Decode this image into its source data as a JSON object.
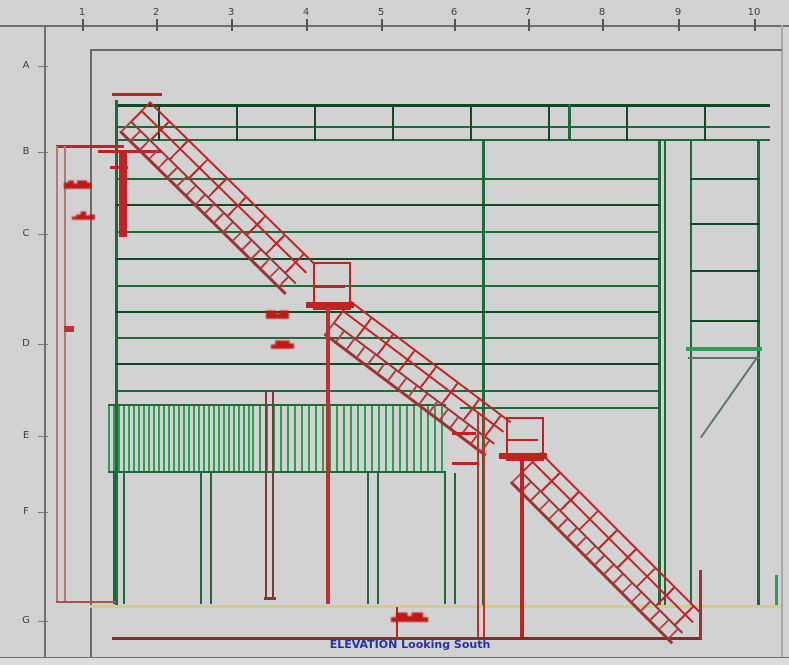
{
  "drawing": {
    "type": "CAD structural elevation drawing",
    "title_caption": "ELEVATION Looking South",
    "grid": {
      "column_labels": [
        "1",
        "2",
        "3",
        "4",
        "5",
        "6",
        "7",
        "8",
        "9",
        "10"
      ],
      "row_labels": [
        "A",
        "B",
        "C",
        "D",
        "E",
        "F",
        "G"
      ]
    },
    "annotations": {
      "elev_note_upper_1": "▆█▅██▆",
      "elev_note_upper_2": "▃▅█▄▅",
      "elev_note_mid_1": "██▅██",
      "elev_note_mid_2": "▄███▅",
      "note_bottom": "▄██▅██▄"
    },
    "colors": {
      "sheet_bg": "#d2d2d2",
      "frame_gray": "#6f6f6f",
      "label_gray": "#3f3f3f",
      "structure_green": "#1d6b38",
      "dark_green": "#0f4a26",
      "bright_green": "#2e9e55",
      "stair_red": "#c32222",
      "stringer_red": "#9c3434",
      "pale_red": "#bb7777",
      "dark_red": "#8a2a2a",
      "brown_red": "#7a3a3a",
      "ground_yellow": "#cfcf8a",
      "caption_blue": "#2531a8",
      "brace_gray_green": "#5a7a64"
    }
  }
}
